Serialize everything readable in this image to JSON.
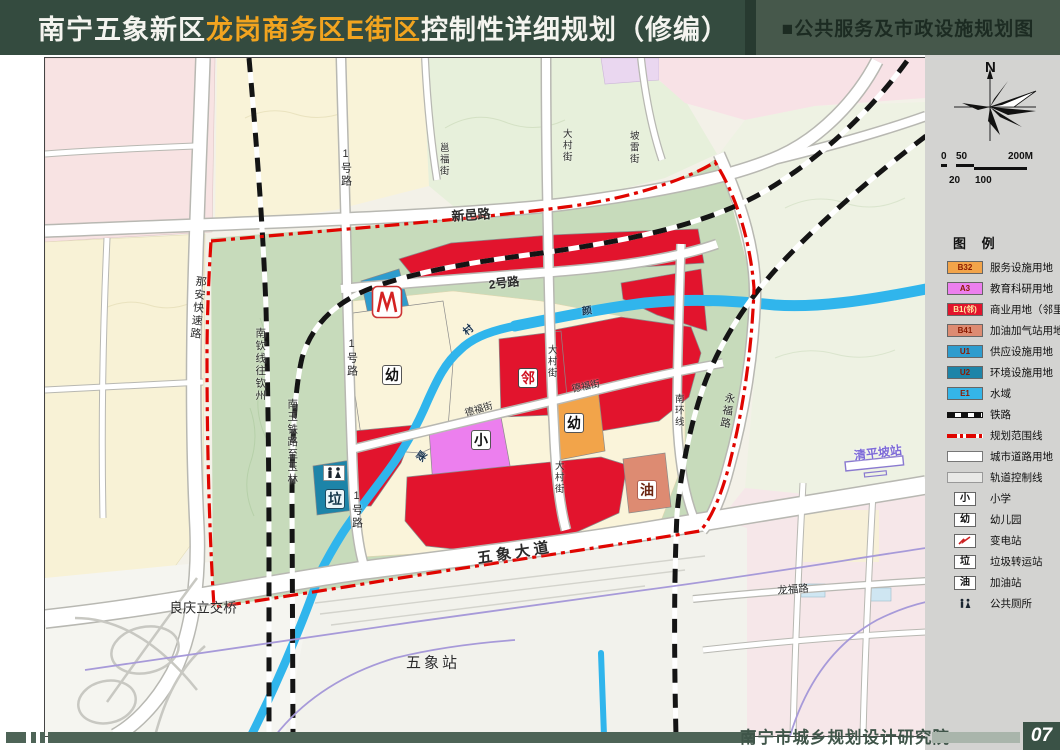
{
  "header": {
    "title_white_1": "南宁五象新区",
    "title_orange": "龙岗商务区E街区",
    "title_white_2": "控制性详细规划（修编）",
    "subtitle": "■公共服务及市政设施规划图"
  },
  "sidebar": {
    "north_label": "N",
    "scalebar": {
      "t0": "0",
      "t50": "50",
      "t200": "200M",
      "t20": "20",
      "t100": "100"
    },
    "legend_title": "图 例",
    "legend_items": [
      {
        "code": "B32",
        "label": "服务设施用地",
        "color": "#F2A44A"
      },
      {
        "code": "A3",
        "label": "教育科研用地",
        "color": "#EC7FEE"
      },
      {
        "code": "B1(邻)",
        "label": "商业用地（邻里中心）",
        "color": "#E2142D"
      },
      {
        "code": "B41",
        "label": "加油加气站用地",
        "color": "#DD8B72"
      },
      {
        "code": "U1",
        "label": "供应设施用地",
        "color": "#2E9CCE"
      },
      {
        "code": "U2",
        "label": "环境设施用地",
        "color": "#1D84A8"
      },
      {
        "code": "E1",
        "label": "水域",
        "color": "#35B5E8"
      },
      {
        "label": "铁路"
      },
      {
        "label": "规划范围线",
        "color": "#E00500"
      },
      {
        "label": "城市道路用地"
      },
      {
        "label": "轨道控制线"
      },
      {
        "char": "小",
        "label": "小学"
      },
      {
        "char": "幼",
        "label": "幼儿园"
      },
      {
        "label": "变电站"
      },
      {
        "char": "垃",
        "label": "垃圾转运站"
      },
      {
        "char": "油",
        "label": "加油站"
      },
      {
        "label": "公共厕所"
      }
    ]
  },
  "map": {
    "labels": {
      "xinyi_road": "新邑路",
      "naan_expwy": "那安快速路",
      "road1": "1号路",
      "road2": "2号路",
      "yongfu_street": "邕福街",
      "polei_street": "坡雷街",
      "dacun_street": "大村街",
      "defu_street": "德福街",
      "nanhuan_line": "南环线",
      "yongfu_road": "永福路",
      "nanqin_rail": "南钦线往钦州",
      "nanyu_rail": "南玉铁路至玉林",
      "wuxiang_avenue": "五象大道",
      "liangqing_interchange": "良庆立交桥",
      "wuxiang_station": "五象站",
      "longfu_road": "龙福路",
      "qingpingpo_station": "清平坡站",
      "creek_cun": "村",
      "creek_yan": "颜",
      "creek_qu": "渠"
    },
    "badges": {
      "neighborhood": "邻",
      "kindergarten": "幼",
      "primary": "小",
      "gas": "油",
      "garbage": "垃"
    }
  },
  "footer": {
    "institute": "南宁市城乡规划设计研究院",
    "page_no": "07"
  }
}
